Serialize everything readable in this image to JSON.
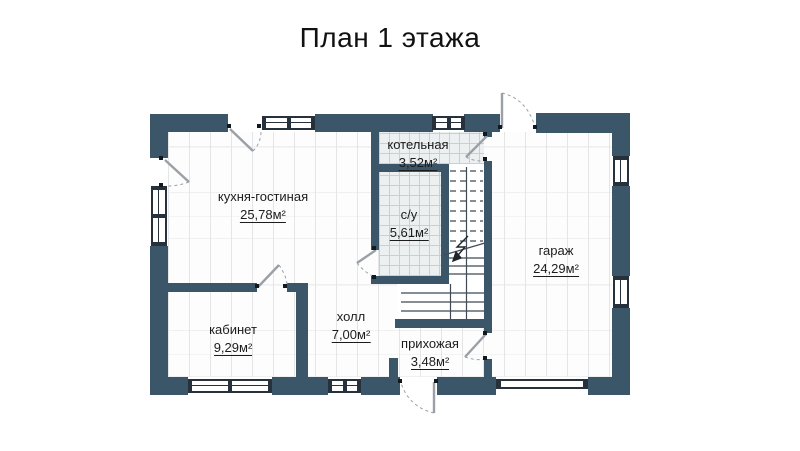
{
  "title": "План 1 этажа",
  "rooms": {
    "kitchen": {
      "name": "кухня-гостиная",
      "area": "25,78м²"
    },
    "boiler": {
      "name": "котельная",
      "area": "3,52м²"
    },
    "bathroom": {
      "name": "с/у",
      "area": "5,61м²"
    },
    "garage": {
      "name": "гараж",
      "area": "24,29м²"
    },
    "office": {
      "name": "кабинет",
      "area": "9,29м²"
    },
    "hall": {
      "name": "холл",
      "area": "7,00м²"
    },
    "entry": {
      "name": "прихожая",
      "area": "3,48м²"
    }
  },
  "colors": {
    "wall": "#3b5668",
    "tile_line": "#c7d0d5",
    "window_frame": "#26313c",
    "text": "#1c1c1c"
  }
}
